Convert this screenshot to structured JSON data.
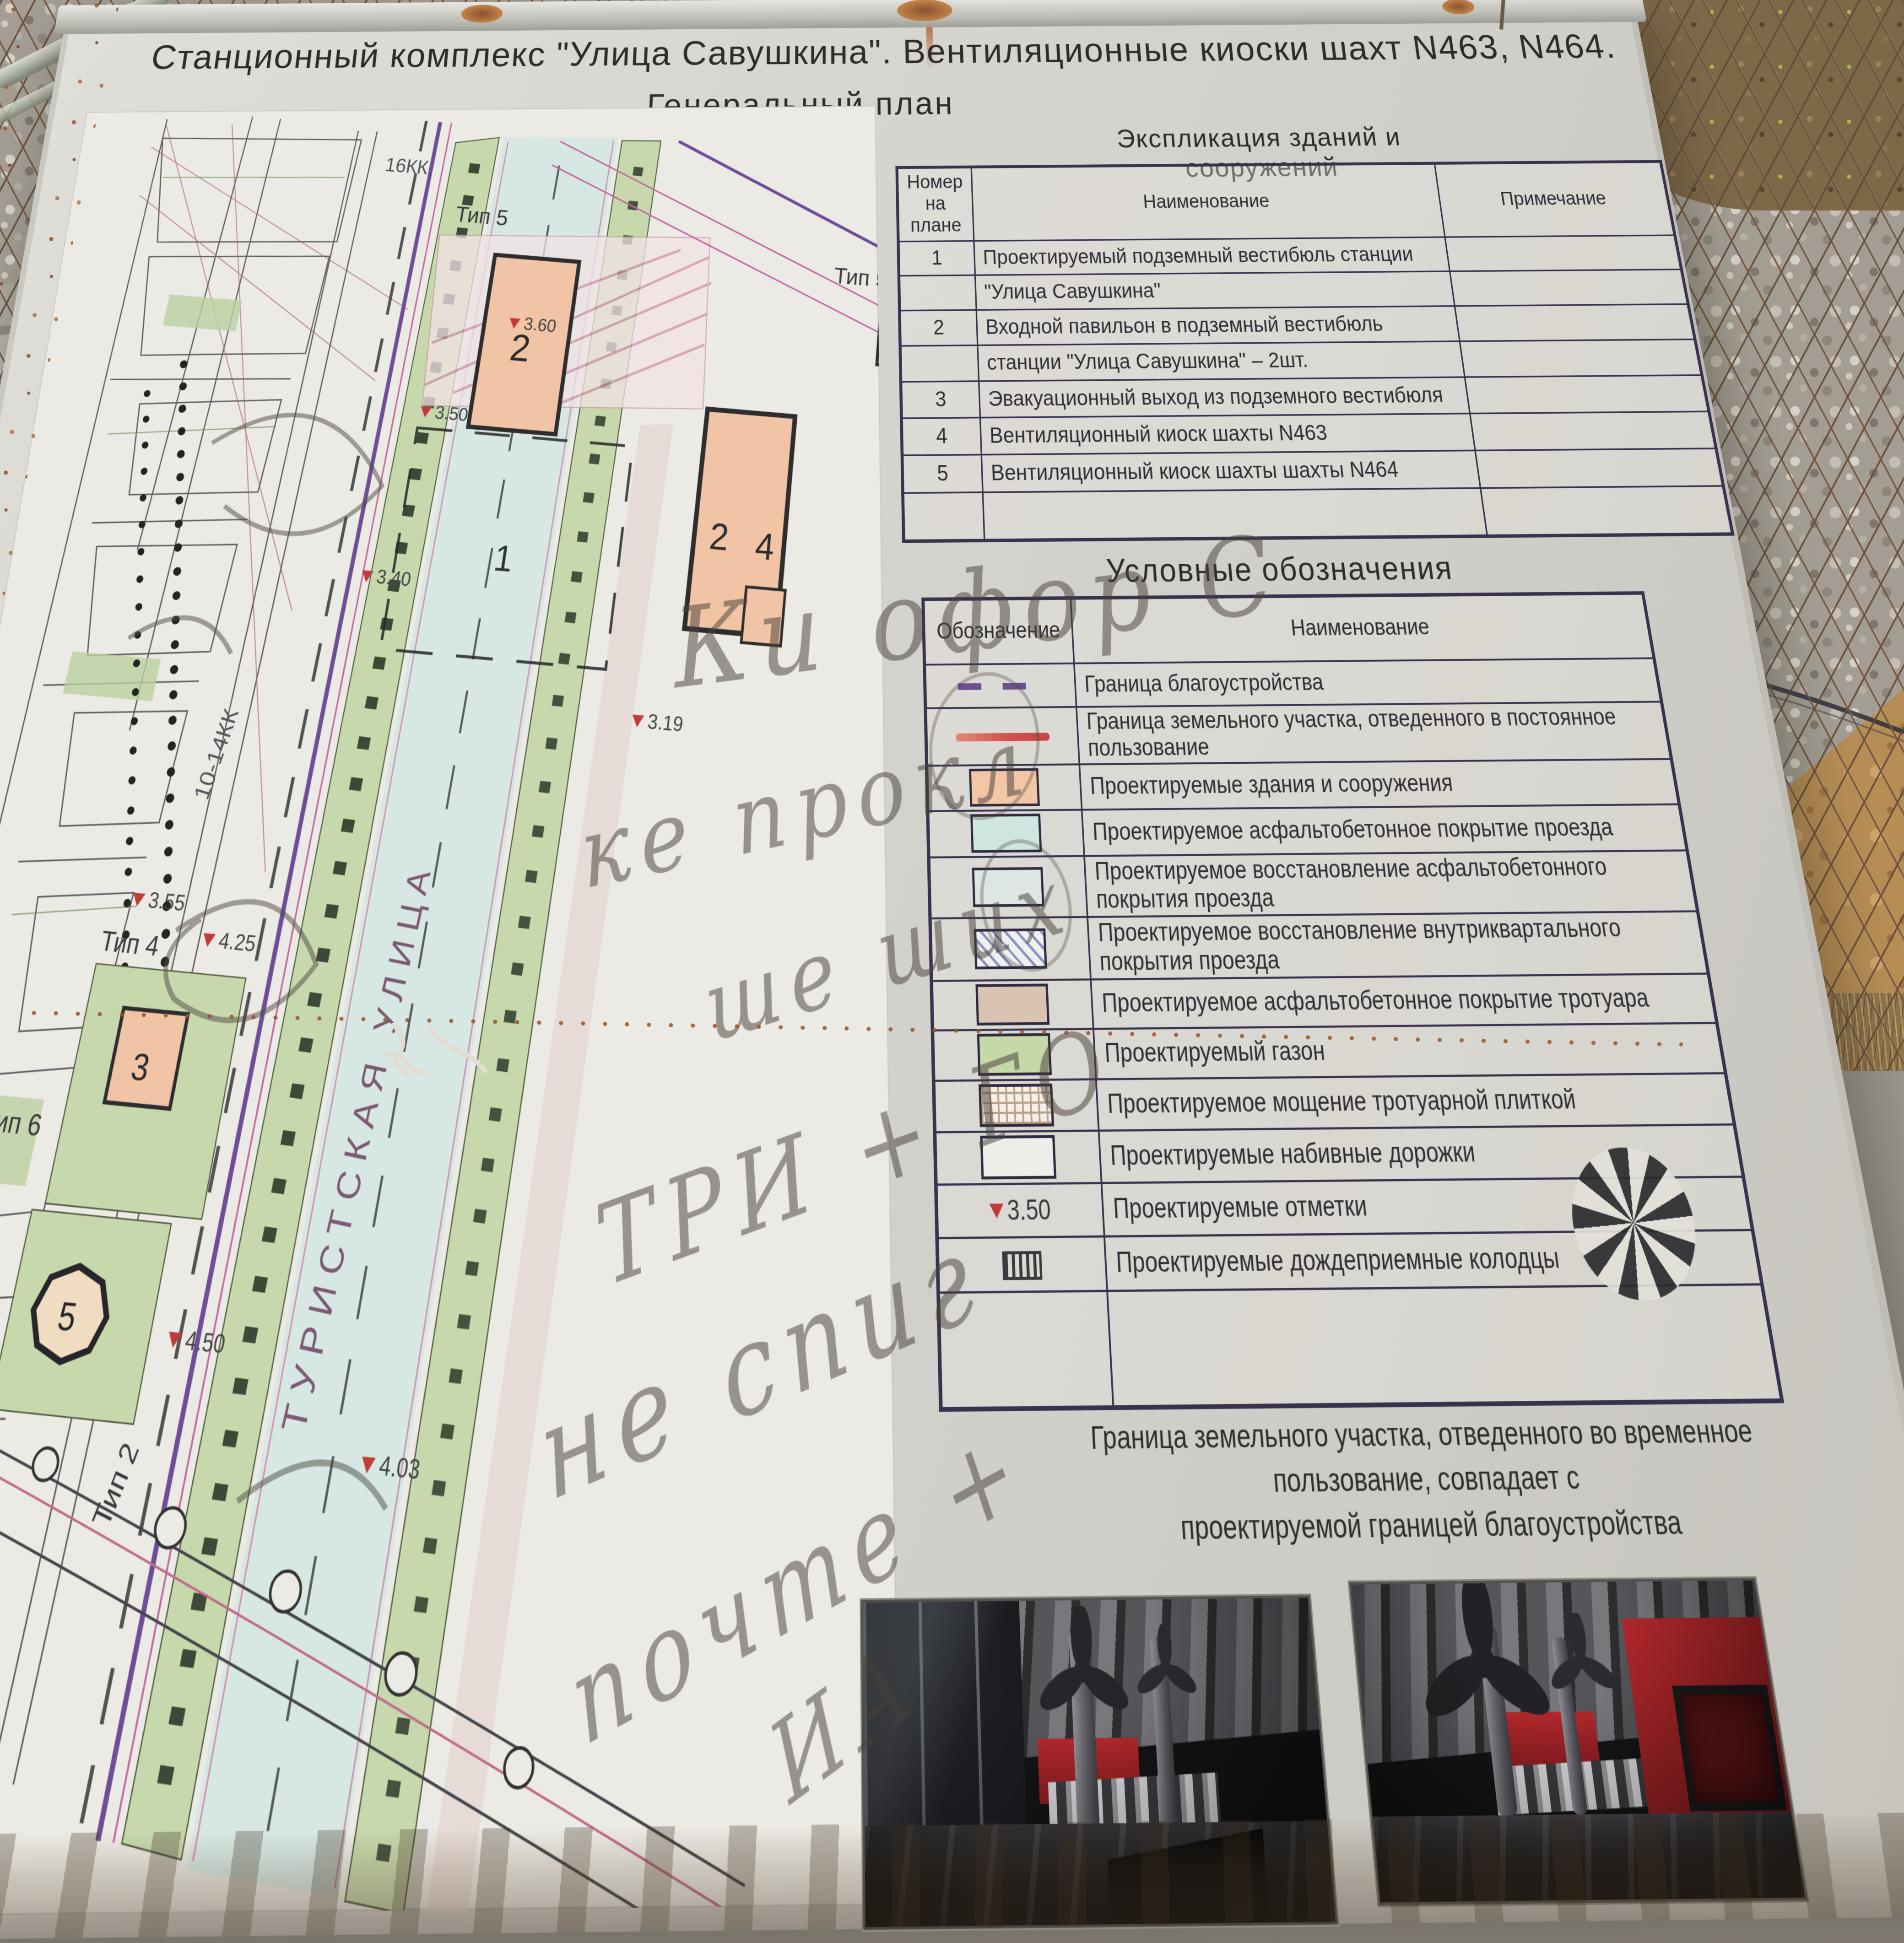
{
  "board": {
    "title": "Станционный комплекс \"Улица Савушкина\". Вентиляционные киоски шахт N463, N464.",
    "subtitle": "Генеральный план",
    "scale": "1:500",
    "note_line1": "Граница земельного участка, отведенного во временное пользование, совпадает с",
    "note_line2": "проектируемой границей благоустройства"
  },
  "explication": {
    "heading": "Экспликация зданий и сооружений",
    "columns": [
      "Номер на плане",
      "Наименование",
      "Примечание"
    ],
    "rows": [
      {
        "num": "1",
        "name": "Проектируемый подземный вестибюль станции",
        "note": ""
      },
      {
        "num": "",
        "name": "\"Улица Савушкина\"",
        "note": ""
      },
      {
        "num": "2",
        "name": "Входной павильон в подземный вестибюль",
        "note": ""
      },
      {
        "num": "",
        "name": "станции \"Улица Савушкина\" – 2шт.",
        "note": ""
      },
      {
        "num": "3",
        "name": "Эвакуационный выход из подземного вестибюля",
        "note": ""
      },
      {
        "num": "4",
        "name": "Вентиляционный киоск шахты N463",
        "note": ""
      },
      {
        "num": "5",
        "name": "Вентиляционный киоск шахты шахты N464",
        "note": ""
      },
      {
        "num": "",
        "name": "",
        "note": ""
      }
    ]
  },
  "legend": {
    "heading": "Условные обозначения",
    "columns": [
      "Обозначение",
      "Наименование"
    ],
    "rows": [
      {
        "icon": "dashed-purple-line",
        "label": "Граница благоустройства"
      },
      {
        "icon": "solid-red-line",
        "label": "Граница земельного участка, отведенного в постоянное пользование"
      },
      {
        "icon": "peach-fill",
        "label": "Проектируемые здания и сооружения"
      },
      {
        "icon": "cyan-fill",
        "label": "Проектируемое асфальтобетонное покрытие проезда"
      },
      {
        "icon": "pale-blue-fill",
        "label": "Проектируемое восстановление асфальтобетонного покрытия проезда"
      },
      {
        "icon": "diagonal-hatch",
        "label": "Проектируемое восстановление внутриквартального покрытия проезда"
      },
      {
        "icon": "tan-fill",
        "label": "Проектируемое асфальтобетонное покрытие тротуара"
      },
      {
        "icon": "green-fill",
        "label": "Проектируемый газон"
      },
      {
        "icon": "grid-hatch",
        "label": "Проектируемое мощение тротуарной плиткой"
      },
      {
        "icon": "white-fill",
        "label": "Проектируемые набивные дорожки"
      },
      {
        "icon": "elevation-mark",
        "label": "Проектируемые отметки",
        "value": "3.50"
      },
      {
        "icon": "drain-grate",
        "label": "Проектируемые дождеприемные колодцы"
      },
      {
        "icon": "",
        "label": ""
      }
    ]
  },
  "plan": {
    "street": "ТУРИСТСКАЯ УЛИЦА",
    "labels": {
      "tip1": "Тип 1",
      "tip2": "Тип 2",
      "tip4": "Тип 4",
      "tip5": "Тип 5",
      "tip5b": "Тип 5",
      "tip6": "Тип 6",
      "kk": "10-14КК",
      "kk16": "16КК",
      "b1": "1",
      "b2": "2",
      "b2b": "2",
      "b4": "4",
      "b3": "3",
      "b5": "5",
      "e360": "3.60",
      "e350": "3.50",
      "e340": "3.40",
      "e319": "3.19",
      "e450": "4.50",
      "e403": "4.03",
      "e355": "3.55",
      "e425": "4.25"
    }
  },
  "graffiti": {
    "w1": "Ки офор С",
    "w2": "ке прокл",
    "w3": "ше ших",
    "w4": "ТРИ + ГО",
    "w5": "не спиг",
    "w6": "почте +",
    "w7": "ИА"
  },
  "colors": {
    "board_bg": "#d7d5cf",
    "line_dark": "#38324e",
    "accent_red": "#d4504f",
    "accent_purple": "#6e4f93",
    "building_fill": "#f0c4a4",
    "lawn_fill": "#c6d8ac",
    "road_fill": "#d7e8e4",
    "render_red_wall": "#a8262a",
    "metal_frame": "#b0b6a8"
  }
}
